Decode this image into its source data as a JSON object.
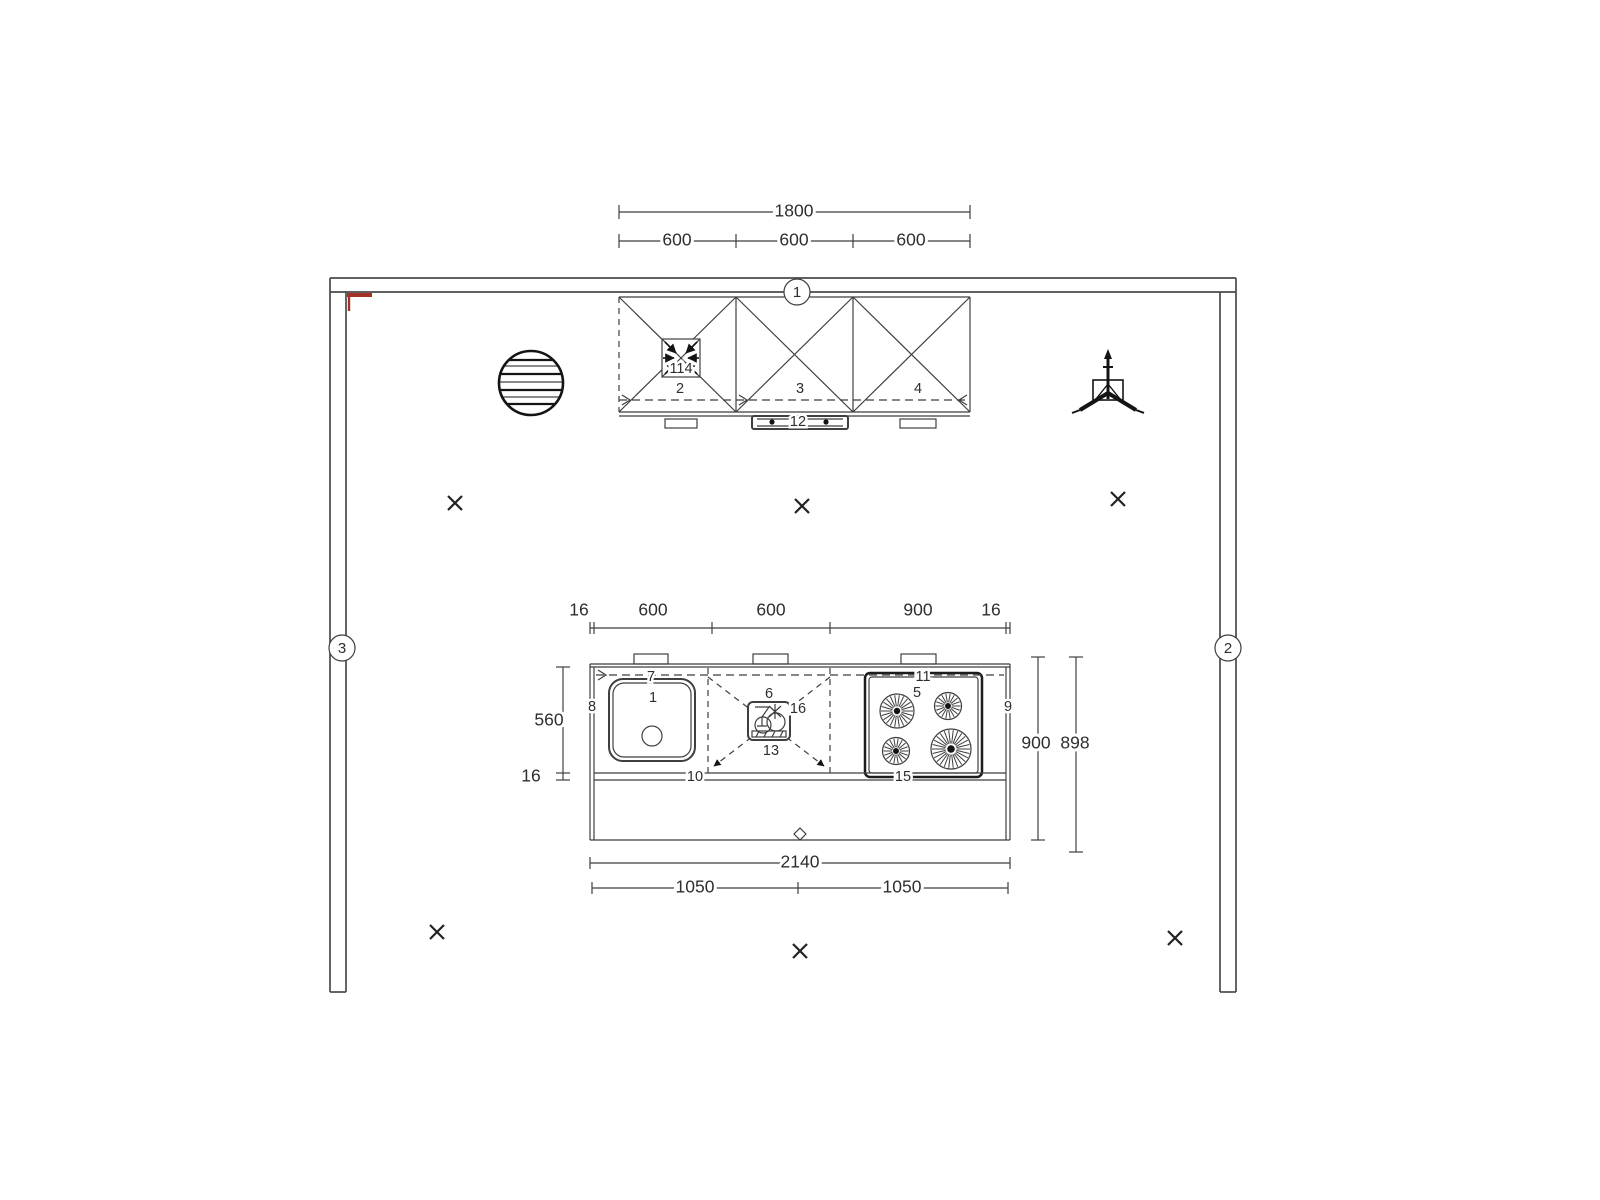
{
  "title": "kitchen-floor-plan",
  "colors": {
    "line": "#3f3f3f",
    "dark": "#141414",
    "accent_red": "#a33327",
    "background": "#ffffff",
    "text": "#2e2e2e"
  },
  "dimensions": {
    "wall_cabinets": {
      "overall": "1800",
      "segments": [
        "600",
        "600",
        "600"
      ]
    },
    "island_top": {
      "left_panel": "16",
      "segments": [
        "600",
        "600",
        "900"
      ],
      "right_panel": "16"
    },
    "island_left": {
      "depth": "560",
      "counter_edge": "16"
    },
    "island_right": {
      "inner": "900",
      "outer": "898"
    },
    "island_bottom": {
      "overall": "2140",
      "segments": [
        "1050",
        "1050"
      ]
    }
  },
  "wall_markers": {
    "top": "1",
    "right": "2",
    "left": "3"
  },
  "item_numbers": {
    "wall_cabinet_left": "2",
    "wall_cabinet_middle": "3",
    "wall_cabinet_right": "4",
    "vent_symbol": "114",
    "wall_rail": "12",
    "sink_base_unit": "1",
    "cooktop": "5",
    "dishwasher": "6",
    "sink_worktop": "7",
    "island_left_panel": "8",
    "island_right_panel": "9",
    "worktop_left": "10",
    "cooktop_worktop": "11",
    "dishwasher_front": "13",
    "worktop_right": "15",
    "dishwasher_gap": "16"
  }
}
